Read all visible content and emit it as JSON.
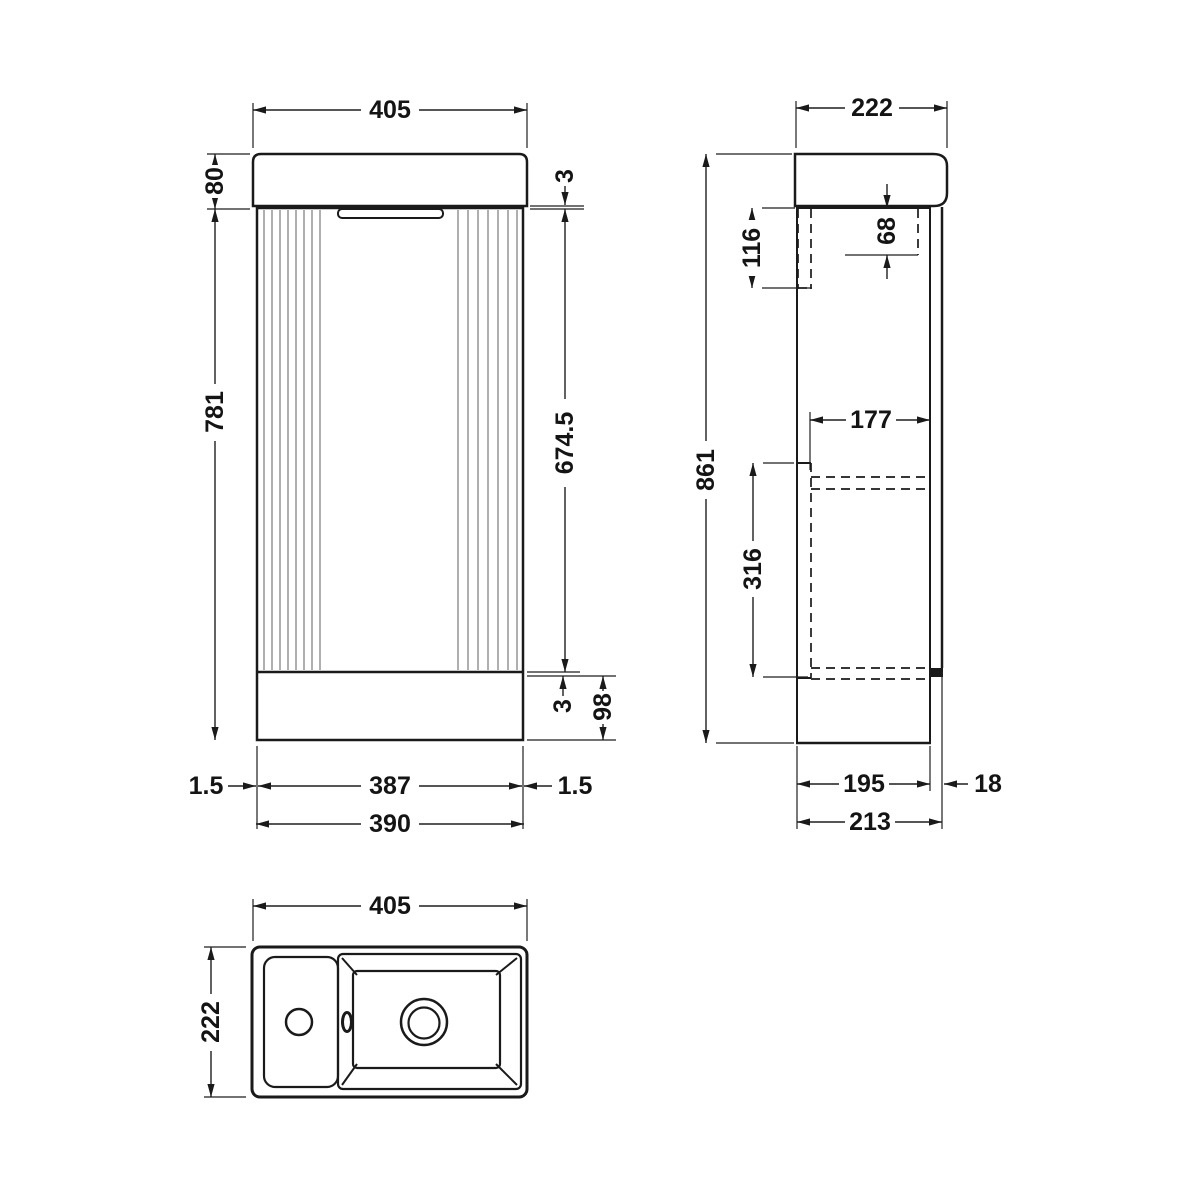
{
  "drawing": {
    "colors": {
      "line": "#1a1a1a",
      "flute": "#9b9b9b",
      "background": "#ffffff"
    },
    "front": {
      "dims": {
        "width_top": "405",
        "countertop_height": "80",
        "top_gap": "3",
        "door_height": "674.5",
        "body_height": "781",
        "bottom_gap": "3",
        "plinth_height": "98",
        "left_margin": "1.5",
        "door_width": "387",
        "right_margin": "1.5",
        "carcass_width": "390"
      }
    },
    "side": {
      "dims": {
        "depth_top": "222",
        "bracket_height": "116",
        "rail_height": "68",
        "overall_height": "861",
        "shelf_depth": "177",
        "back_panel_height": "316",
        "carcass_depth": "195",
        "door_thickness": "18",
        "overall_depth": "213"
      }
    },
    "plan": {
      "dims": {
        "width": "405",
        "depth": "222"
      }
    }
  }
}
